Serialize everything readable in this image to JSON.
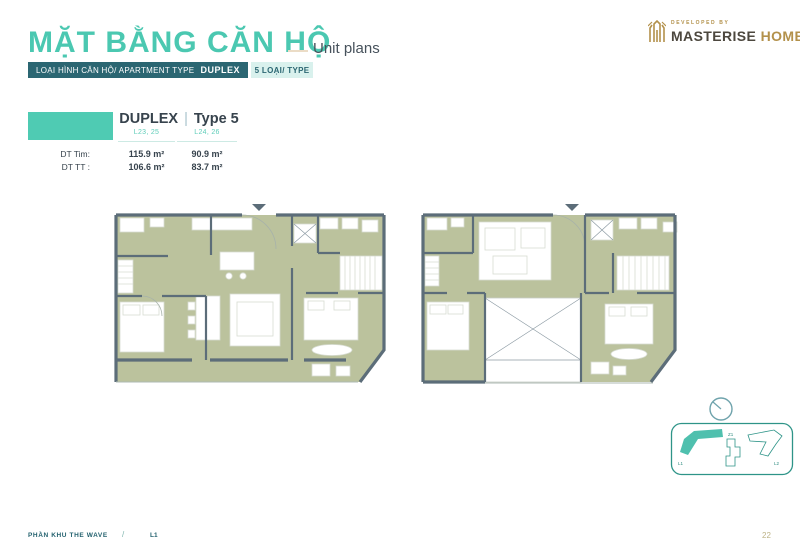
{
  "page": {
    "page_number": "22"
  },
  "header": {
    "title": "MẶT BẰNG CĂN HỘ",
    "subtitle": "Unit plans",
    "logo": {
      "developed_by": "DEVELOPED BY",
      "brand": "MASTERISE",
      "brand_suffix": "HOMES"
    }
  },
  "type_bar": {
    "label": "LOẠI HÌNH CĂN HỘ/ APARTMENT TYPE",
    "value": "DUPLEX",
    "count": "5 LOẠI/ TYPE"
  },
  "unit_info": {
    "type_name": "DUPLEX",
    "separator": "|",
    "variant": "Type 5",
    "row_labels": {
      "dt_tim": "DT Tim:",
      "dt_tt": "DT TT :"
    },
    "columns": [
      {
        "levels": "L23, 25",
        "dt_tim": "115.9 m²",
        "dt_tt": "106.6 m²"
      },
      {
        "levels": "L24, 26",
        "dt_tim": "90.9 m²",
        "dt_tt": "83.7 m²"
      }
    ]
  },
  "key_plan": {
    "buildings": [
      {
        "label": "L1",
        "highlighted": true
      },
      {
        "label": "Z1",
        "highlighted": false
      },
      {
        "label": "L2",
        "highlighted": false
      }
    ]
  },
  "footer": {
    "zone": "PHẦN KHU THE WAVE",
    "separator": "/",
    "level": "L1"
  },
  "colors": {
    "accent_teal": "#4BC8B1",
    "dark_teal": "#2B6672",
    "light_mint": "#D9F1ED",
    "floor_green": "#BBC29D",
    "wall_slate": "#5C6D79",
    "gold": "#B3914B",
    "text_dark": "#37434D"
  }
}
